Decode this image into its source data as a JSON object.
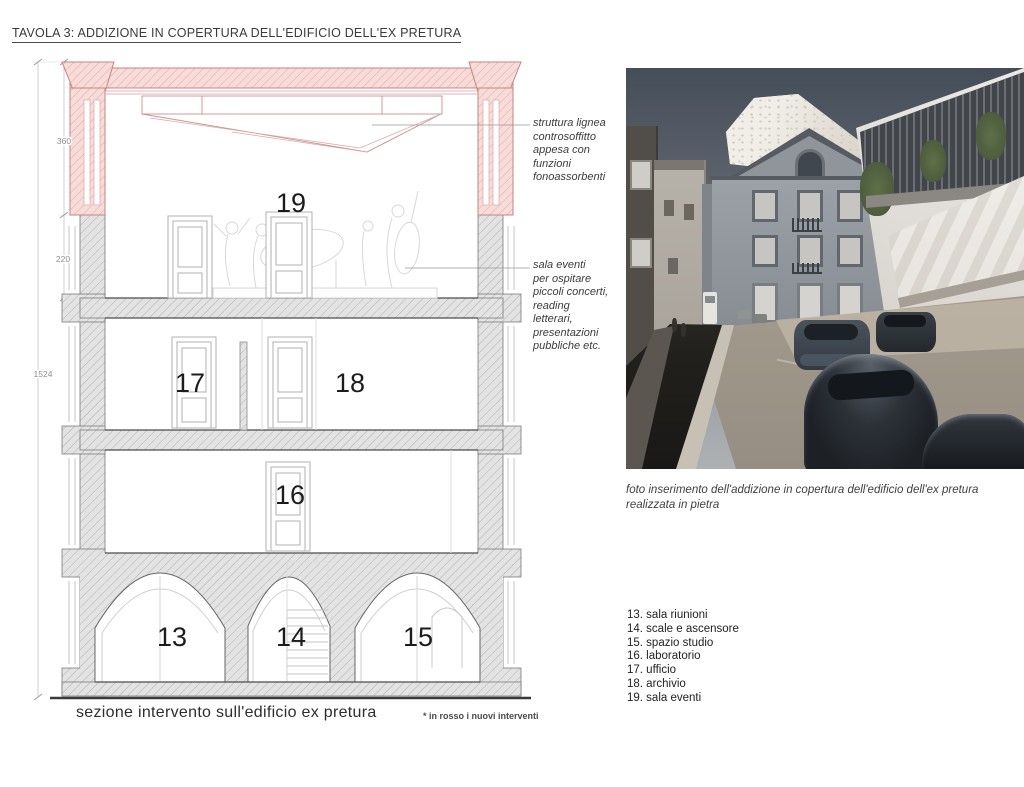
{
  "title": "TAVOLA 3: ADDIZIONE IN COPERTURA DELL'EDIFICIO DELL'EX PRETURA",
  "colors": {
    "new_intervention_fill": "#f8dcda",
    "new_intervention_line": "#c98383",
    "existing_fill": "#e3e3e3",
    "existing_line": "#7a7a7a"
  },
  "section": {
    "room_labels": {
      "r13": "13",
      "r14": "14",
      "r15": "15",
      "r16": "16",
      "r17": "17",
      "r18": "18",
      "r19": "19"
    },
    "dimensions": {
      "d360": "360",
      "d220": "220",
      "d1524": "1524"
    },
    "annotations": [
      {
        "text": "struttura lignea\ncontrosoffitto\nappesa con\nfunzioni\nfonoassorbenti"
      },
      {
        "text": "sala eventi\nper ospitare\npiccoli concerti,\nreading\nletterari,\npresentazioni\npubbliche etc."
      }
    ],
    "caption": "sezione intervento sull'edificio ex pretura",
    "note": "* in rosso i nuovi interventi"
  },
  "photo": {
    "caption": "foto inserimento dell'addizione in copertura dell'edificio dell'ex pretura\nrealizzata in pietra"
  },
  "legend": {
    "items": [
      "13. sala riunioni",
      "14. scale e ascensore",
      "15. spazio studio",
      "16. laboratorio",
      "17. ufficio",
      "18. archivio",
      "19. sala eventi"
    ]
  }
}
